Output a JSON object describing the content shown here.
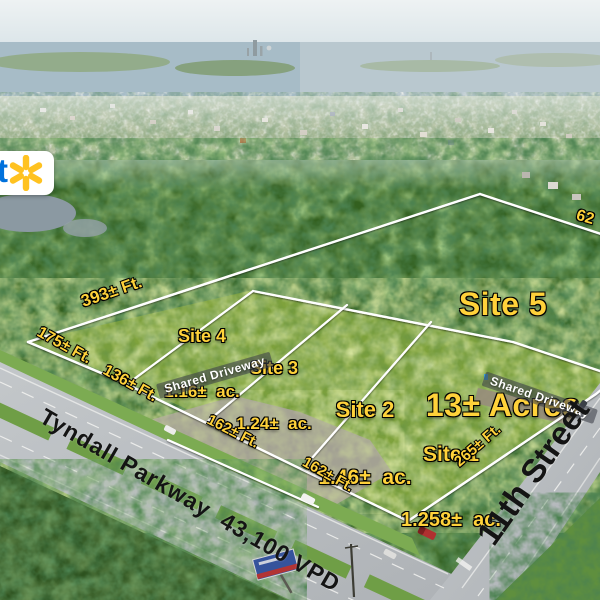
{
  "branding": {
    "wordmark_letter": "t",
    "spark_icon": "walmart-spark-icon",
    "spark_color": "#ffc220",
    "wordmark_blue": "#0071dc"
  },
  "parcels": {
    "site5": {
      "name": "Site 5",
      "area": "13± Acres"
    },
    "site4": {
      "name": "Site 4",
      "area": "1.16±  ac."
    },
    "site3": {
      "name": "Site 3",
      "area": "1.24±  ac."
    },
    "site2": {
      "name": "Site 2",
      "area": "1.46±  ac."
    },
    "site1": {
      "name": "Site 1",
      "area": "1.258±  ac."
    }
  },
  "dimensions": {
    "d393": "393± Ft.",
    "d175": "175± Ft.",
    "d136": "136± Ft.",
    "d162_west": "162± Ft.",
    "d162_east": "162± Ft.",
    "d265": "265± Ft.",
    "d62_partial": "62"
  },
  "driveways": {
    "west": "Shared Driveway",
    "east": "Shared Driveway"
  },
  "roads": {
    "tyndall": "Tyndall Parkway  43,100 VPD",
    "eleventh": "11th Street"
  },
  "colors": {
    "label_yellow": "#ffd23a",
    "boundary_white": "#ffffff",
    "road_label_black": "#141414"
  }
}
